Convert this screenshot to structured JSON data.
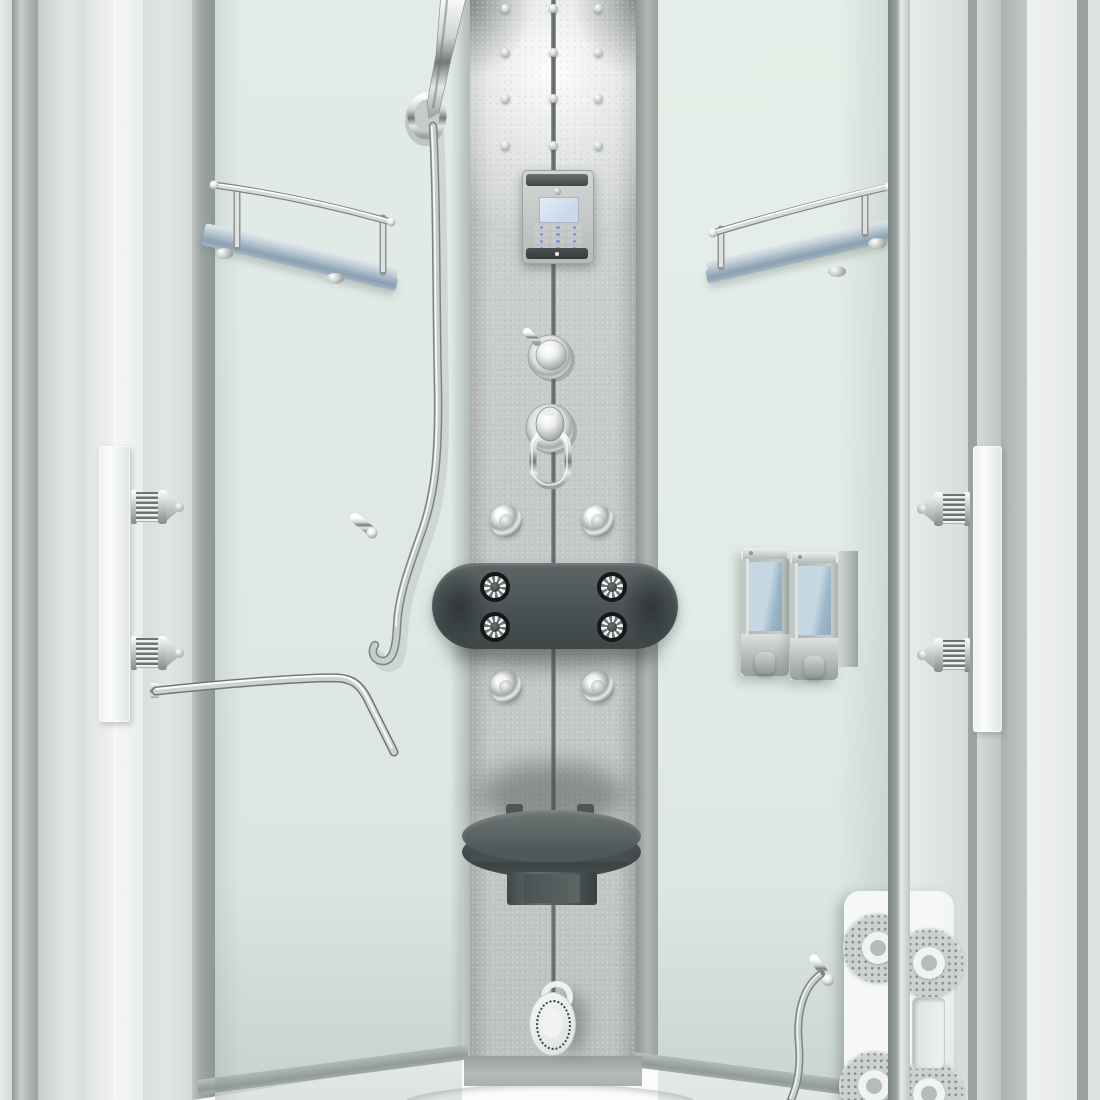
{
  "scene": {
    "title": "Steam shower cabin interior",
    "description": "3D render of a white corner steam shower cabin interior: central fixture column with touch control panel, thermostat dial, diverter with pull ring, four chrome body jets, dark cushioned headrest with four massage jets, fold-up seat and foot massage jet; mint-green glass walls with two blue glass corner shelves with chrome rails, hand shower with hose, chrome grab bar, twin wall-mounted soap dispensers, white speaker/jet panel with storage niche, sliding glass doors with vertical white handles and knurled chrome roller pins, white quadrant shower tray",
    "parts": {
      "hand_shower": "Hand shower with flexible hose",
      "control_panel": "Touch control panel with blue display and 12-key pad",
      "thermostat_knob": "Thermostat dial with lever",
      "diverter": "Diverter knob with chrome pull ring",
      "body_jets": "Four chrome body massage jets",
      "headrest": "Cushioned headrest with four massage jets",
      "seat": "Fold-up round seat",
      "foot_jet": "Perforated foot massage jet",
      "shelves": "Two frosted blue glass shelves with chrome rails",
      "dispensers": "Twin wall soap dispensers with blue reservoirs",
      "speaker_panel": "Speaker and jet panel with recessed niche",
      "grab_bar": "Chrome angled grab bar",
      "door_handles": "Two vertical white door handle strips",
      "door_pins": "Knurled chrome door roller pins",
      "tray": "White quadrant shower tray"
    },
    "counts": {
      "panel_screws": 12,
      "keypad_keys": 12,
      "body_jets": 4,
      "headrest_jets": 4,
      "speaker_discs": 4,
      "dispensers": 2,
      "shelves": 2,
      "door_handles": 2,
      "door_pins": 4
    }
  },
  "colors": {
    "wall-mint": "#dfe8e4",
    "wall-mint-r": "#e2ebe6",
    "panel-gray": "#c6cac7",
    "seam-dark": "#555d5b",
    "fixture-dark": "#4a5253",
    "chrome-mid": "#c7cdcb",
    "shelf-blue": "#8ba0b1",
    "dispenser-blue": "#9db9c9",
    "screen-blue": "#ccd8ea",
    "key-blue": "#6f8fd8",
    "frame-white": "#f6f8f7",
    "tray-white": "#fafbfa"
  }
}
